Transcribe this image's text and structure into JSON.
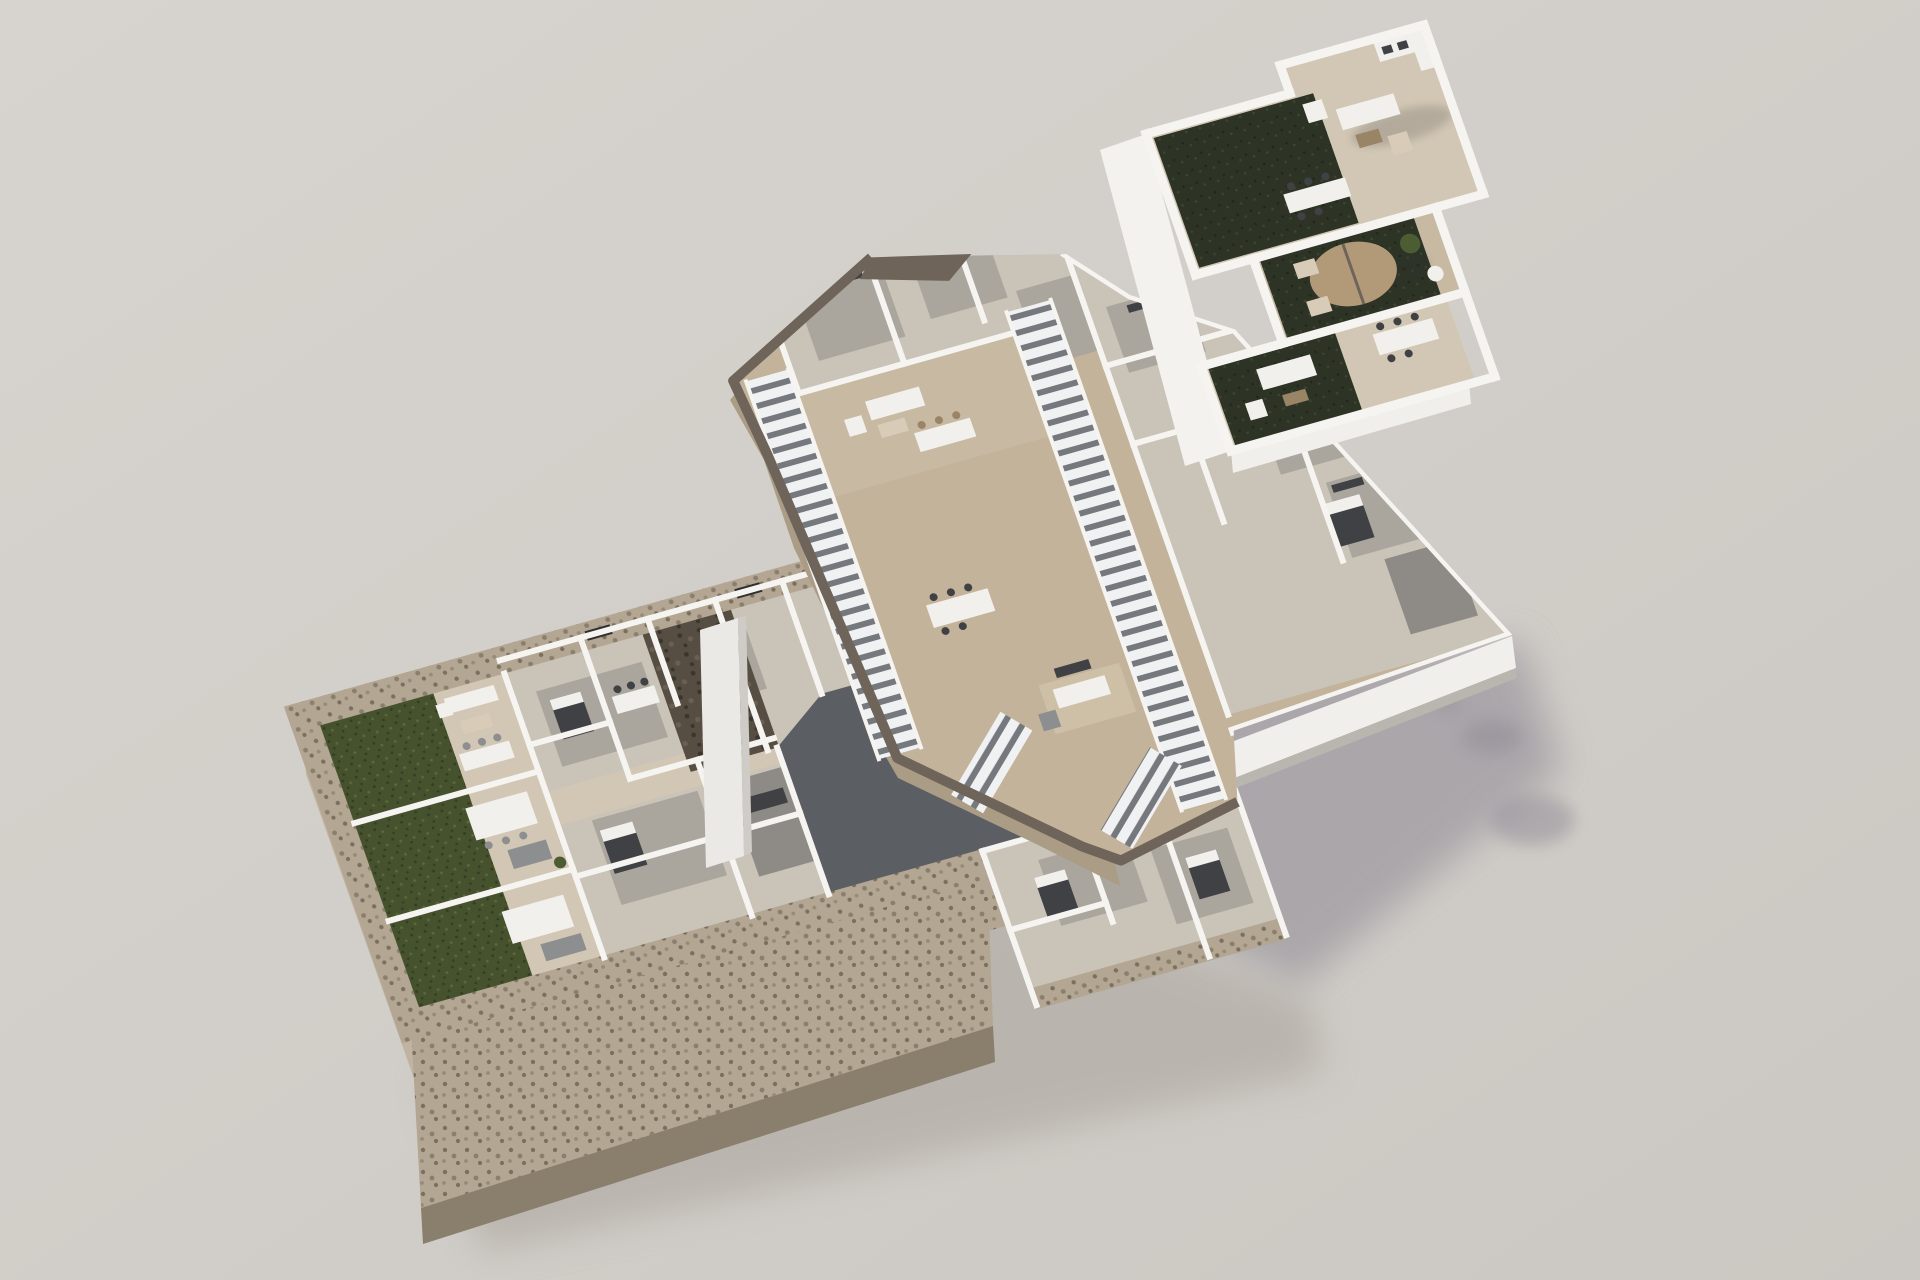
{
  "image": {
    "kind": "architectural-3d-render",
    "description": "Exploded axonometric 3D floor-plan rendering of a three-level residential building floating over a neutral studio background",
    "text_visible": ""
  },
  "colors": {
    "background": "#d4d0cb",
    "background_edge": "#c6c2bd",
    "shadow": "#94909a",
    "shadow_soft": "#a59f97",
    "stone": "#b3a692",
    "stone_dark": "#7b7060",
    "stone_deep": "#574e43",
    "stone_deep_dot": "#3c352c",
    "grass": "#46522e",
    "grass_dark": "#323d22",
    "grass_light": "#5a6a3a",
    "turf": "#2d3426",
    "turf_dark": "#20261b",
    "turf_light": "#3c4630",
    "tile": "#d2c7b4",
    "tile_warm": "#c7b9a2",
    "deck": "#c3b39b",
    "deck_edge": "#6e6459",
    "deck_edge_tan": "#ab9c85",
    "wall": "#f5f4f1",
    "wall_lit": "#ebe9e5",
    "wall_shade": "#cfccc7",
    "fascia": "#f1efec",
    "floor": "#cac3b8",
    "floor_gray": "#aaa59d",
    "floor_dark": "#8e8b86",
    "courtyard": "#5b5e63",
    "stair_gap": "#75787d",
    "stair_tread": "#f0f1f2",
    "furn_dark": "#404144",
    "furn_gray": "#8d8e90",
    "furn_white": "#f2f0ec",
    "furn_beige": "#d8ccb8",
    "furn_brown": "#9a8466",
    "rug": "#cdc0a6",
    "plant": "#4c5d34",
    "umbrella": "#b29a78",
    "glass_dark": "#2e2f31"
  },
  "levels": [
    {
      "id": "ground-floor",
      "features": [
        "stone perimeter wall",
        "garden lawn 1",
        "garden lawn 2",
        "garden lawn 3",
        "garden pergolas",
        "terrace sofas",
        "bedrooms",
        "living rooms",
        "sunken dark courtyard"
      ]
    },
    {
      "id": "middle-floor",
      "features": [
        "jagged terrain edge",
        "long staircase left",
        "long staircase right",
        "short connecting stairs",
        "terrace lounge",
        "dining tables",
        "bedrooms",
        "white fascia"
      ]
    },
    {
      "id": "roof-terrace",
      "features": [
        "artificial turf panels",
        "parapet walls",
        "lounge seating",
        "outdoor dining tables",
        "umbrella pergola",
        "potted plants"
      ]
    }
  ]
}
